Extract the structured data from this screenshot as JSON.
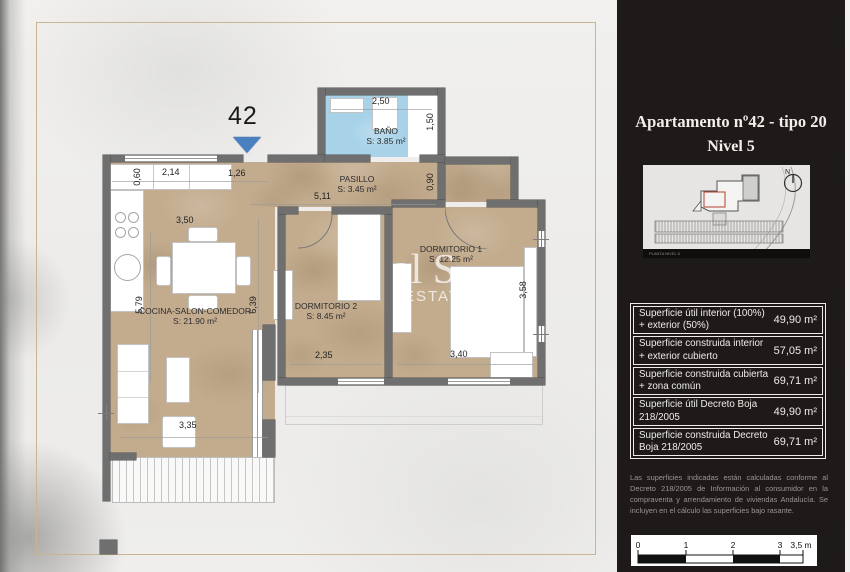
{
  "colors": {
    "bath_blue": "#a7d2e8",
    "floor_tan": "#c3ac8e",
    "wall_gray": "#6f6f6f",
    "panel_dark": "#1d1a19",
    "entrance_blue": "#4a80c0",
    "frame_tan": "#c9b592"
  },
  "plan": {
    "unit_number": "42",
    "rooms": [
      {
        "name": "BAÑO",
        "area": "S: 3.85 m²"
      },
      {
        "name": "PASILLO",
        "area": "S: 3.45 m²"
      },
      {
        "name": "DORMITORIO 1",
        "area": "S: 12.25 m²"
      },
      {
        "name": "DORMITORIO 2",
        "area": "S: 8.45 m²"
      },
      {
        "name": "COCINA-SALON-COMEDOR",
        "area": "S: 21.90 m²"
      }
    ],
    "dims": [
      "0,60",
      "2,14",
      "1,26",
      "3,50",
      "5,79",
      "6,39",
      "5,11",
      "0,90",
      "2,50",
      "1,50",
      "2,35",
      "3,40",
      "3,58",
      "3,35"
    ],
    "watermark_line1": "al S",
    "watermark_line2": "ESTATE"
  },
  "panel": {
    "title_line1": "Apartamento nº42 - tipo 20",
    "title_line2": "Nivel 5",
    "inset": {
      "north_label": "N",
      "caption": "PLANTA NIVEL 5"
    },
    "table": [
      {
        "label": "Superficie útil interior (100%) + exterior (50%)",
        "value": "49,90 m²"
      },
      {
        "label": "Superficie construida interior + exterior cubierto",
        "value": "57,05 m²"
      },
      {
        "label": "Superficie construida cubierta + zona común",
        "value": "69,71 m²"
      },
      {
        "label": "Superficie útil Decreto Boja 218/2005",
        "value": "49,90 m²"
      },
      {
        "label": "Superficie construida Decreto Boja 218/2005",
        "value": "69,71 m²"
      }
    ],
    "disclaimer": "Las superficies indicadas están calculadas conforme al Decreto 218/2005 de Información al consumidor en la compraventa y arrendamiento de viviendas Andalucía. Se incluyen en el cálculo las superficies bajo rasante.",
    "scale": {
      "t0": "0",
      "t1": "1",
      "t2": "2",
      "t3": "3",
      "t35": "3,5 m"
    }
  }
}
